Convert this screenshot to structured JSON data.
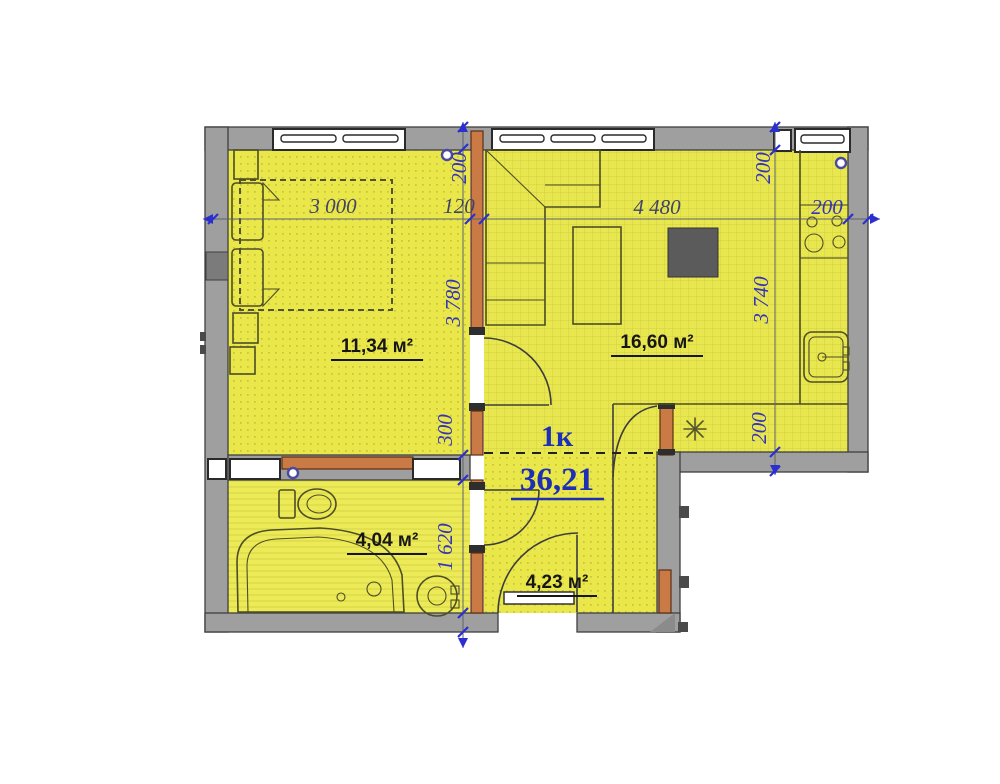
{
  "plan": {
    "type_label": "1к",
    "total_area": "36,21",
    "areas": {
      "bedroom": "11,34 м²",
      "living": "16,60 м²",
      "bathroom": "4,04 м²",
      "hallway": "4,23 м²"
    },
    "dims": {
      "h": [
        "3 000",
        "120",
        "4 480",
        "200"
      ],
      "vl": [
        "200",
        "3 780",
        "300",
        "1 620"
      ],
      "vr": [
        "200",
        "3 740",
        "200"
      ]
    },
    "colors": {
      "floor_yellow": "#eae74b",
      "wall_gray": "#9f9f9f",
      "brick_orange": "#c97a45",
      "dim_blue": "#2b2fd0",
      "label_blue": "#1c2fb5"
    }
  }
}
